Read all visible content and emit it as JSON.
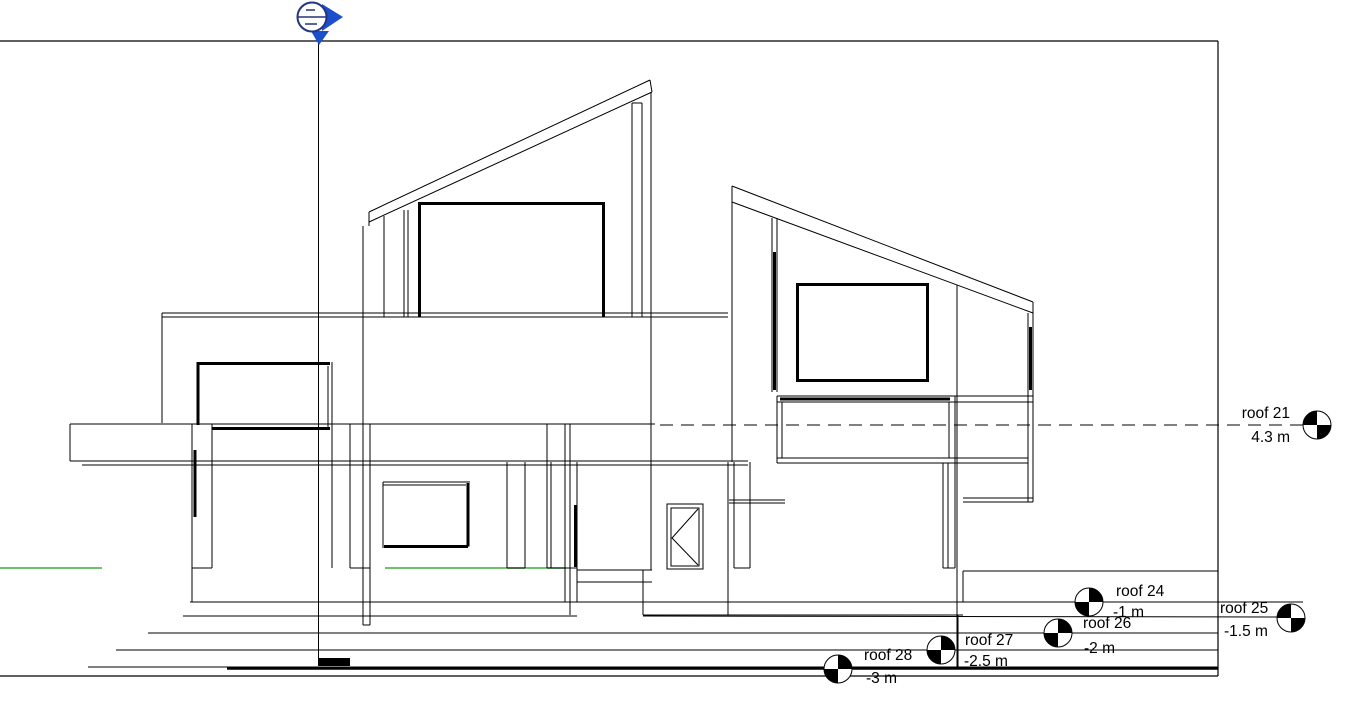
{
  "view": {
    "levels": [
      {
        "id": "roof21",
        "name": "roof 21",
        "elevation": "4.3 m"
      },
      {
        "id": "roof24",
        "name": "roof 24",
        "elevation": "-1 m"
      },
      {
        "id": "roof25",
        "name": "roof 25",
        "elevation": "-1.5 m"
      },
      {
        "id": "roof26",
        "name": "roof 26",
        "elevation": "-2 m"
      },
      {
        "id": "roof27",
        "name": "roof 27",
        "elevation": "-2.5 m"
      },
      {
        "id": "roof28",
        "name": "roof 28",
        "elevation": "-3 m"
      }
    ],
    "icons": {
      "section_head": "section-head-icon",
      "level_head": "level-head-icon"
    },
    "colors": {
      "background": "#ffffff",
      "linework": "#000000",
      "terrain_green": "#3aae3a",
      "section_marker_blue": "#1b4fcc",
      "section_marker_outline": "#23357e"
    }
  }
}
